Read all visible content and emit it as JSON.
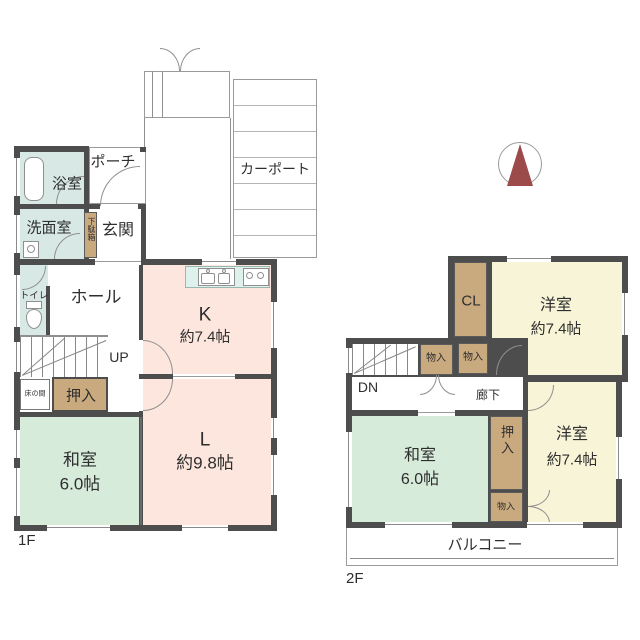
{
  "compass": {
    "north_label": "N",
    "arrow_color": "#9c4a4a"
  },
  "floor1": {
    "label": "1F",
    "bath": "浴室",
    "porch": "ポーチ",
    "carport": "カーポート",
    "washroom": "洗面室",
    "shoe_cabinet": "下駄箱",
    "entrance": "玄関",
    "toilet": "トイレ",
    "hall": "ホール",
    "kitchen_label": "K",
    "kitchen_size": "約7.4帖",
    "stairs": "UP",
    "tokonoma": "床の間",
    "oshiire": "押入",
    "washitsu_label": "和室",
    "washitsu_size": "6.0帖",
    "living_label": "L",
    "living_size": "約9.8帖"
  },
  "floor2": {
    "label": "2F",
    "cl": "CL",
    "youshitsu1_label": "洋室",
    "youshitsu1_size": "約7.4帖",
    "monoire1": "物入",
    "monoire2": "物入",
    "stairs": "DN",
    "corridor": "廊下",
    "washitsu_label": "和室",
    "washitsu_size": "6.0帖",
    "oshiire": "押入",
    "monoire3": "物入",
    "youshitsu2_label": "洋室",
    "youshitsu2_size": "約7.4帖",
    "balcony": "バルコニー"
  },
  "colors": {
    "wall": "#4d4d4d",
    "tatami_green": "#d7ebda",
    "wood_brown": "#c9a97e",
    "room_pink": "#fce6dd",
    "room_yellow": "#f8f4d7",
    "wet_teal": "#d8e9e5",
    "compass_red": "#9c4a4a"
  }
}
